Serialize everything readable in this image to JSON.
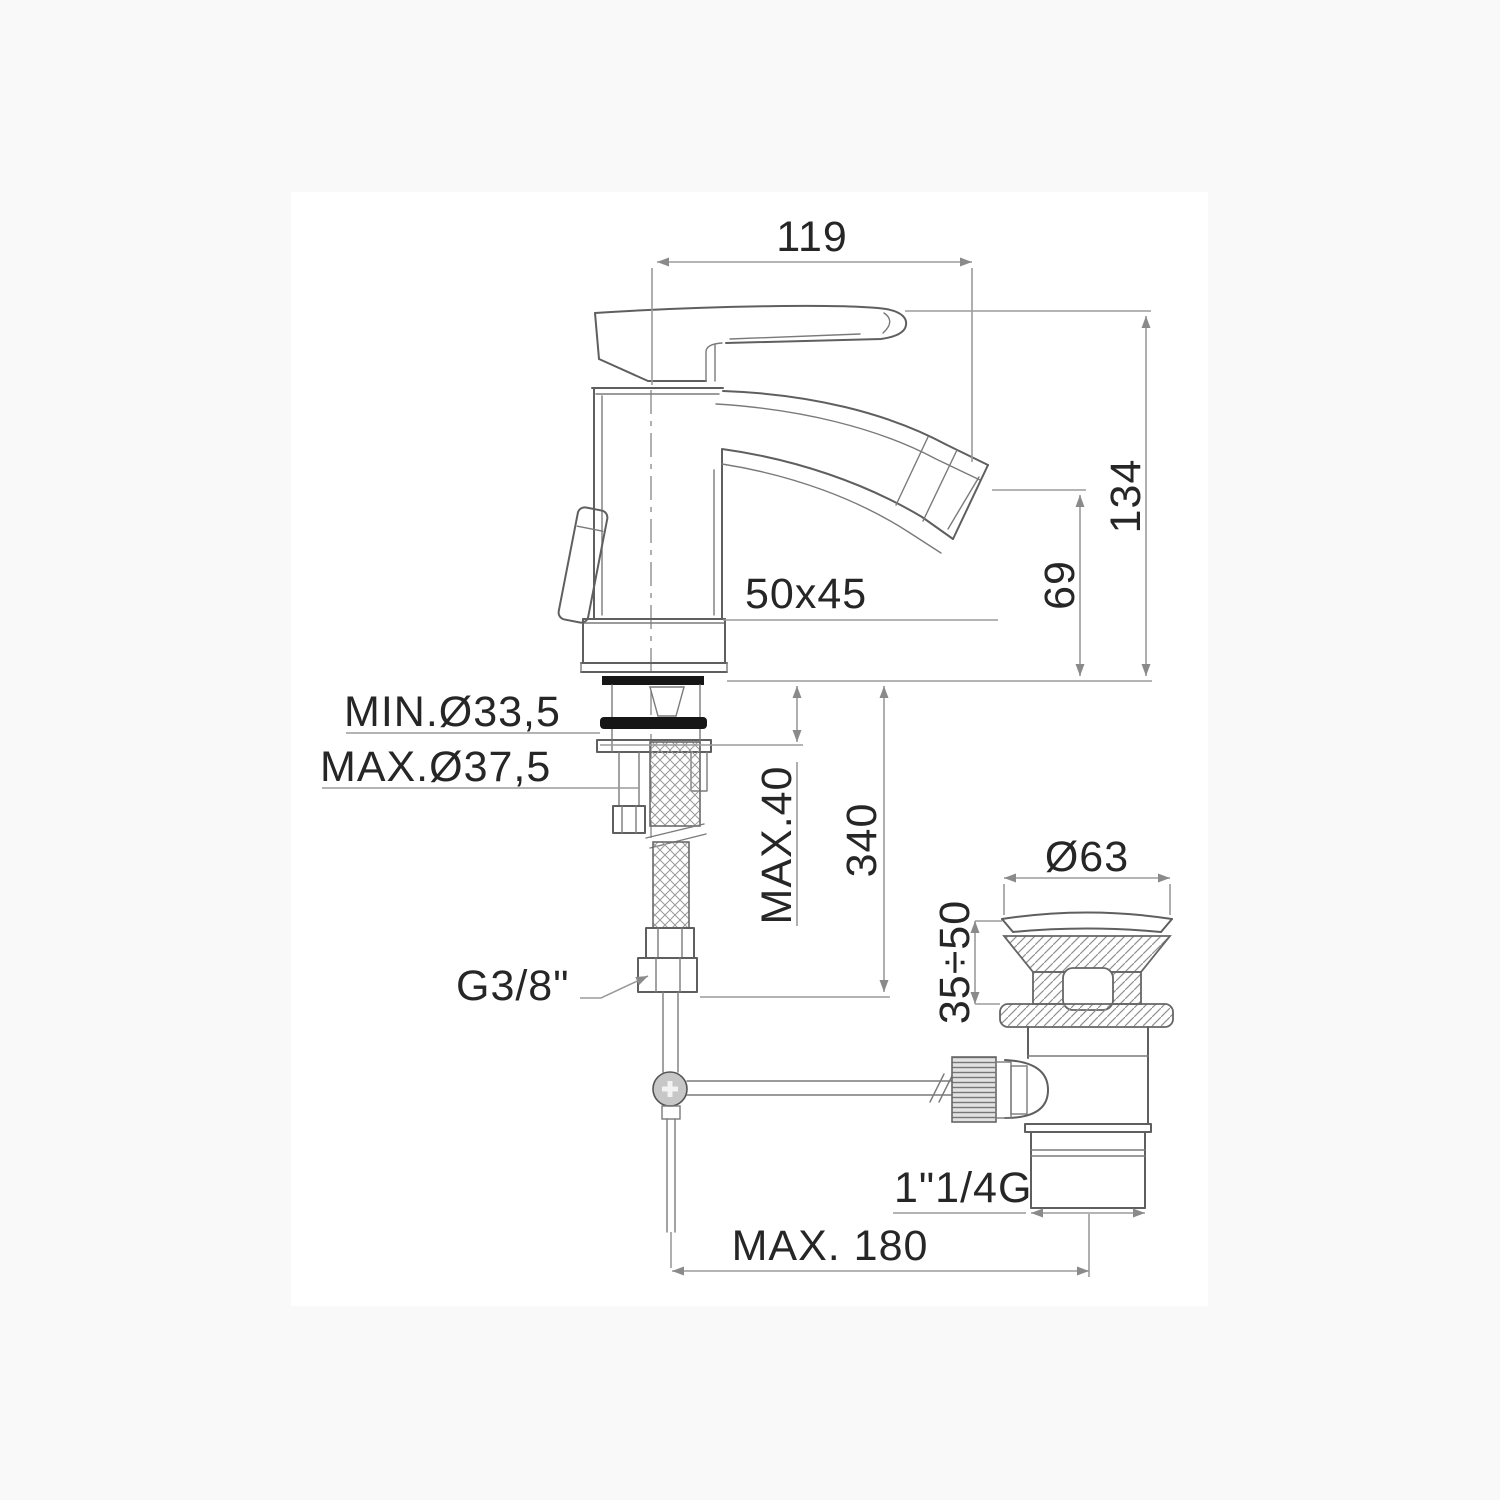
{
  "drawing": {
    "type": "technical-dimension-drawing",
    "subject": "single-lever bidet mixer with pop-up waste",
    "colors": {
      "page_background": "#f9f9f9",
      "canvas_background": "#ffffff",
      "object_line": "#5f5f5f",
      "dimension_line": "#9b9b9b",
      "text": "#262626",
      "gasket_fill": "#161616"
    },
    "dims": {
      "spout_reach": "119",
      "total_height": "134",
      "spout_height": "69",
      "body_section": "50x45",
      "hole_min": "MIN.Ø33,5",
      "hole_max": "MAX.Ø37,5",
      "deck_thickness": "MAX.40",
      "hose_length": "340",
      "waste_flange_diameter": "Ø63",
      "waste_deck_range": "35÷50",
      "supply_thread": "G3/8\"",
      "waste_thread": "1\"1/4G",
      "rod_reach": "MAX. 180"
    }
  }
}
